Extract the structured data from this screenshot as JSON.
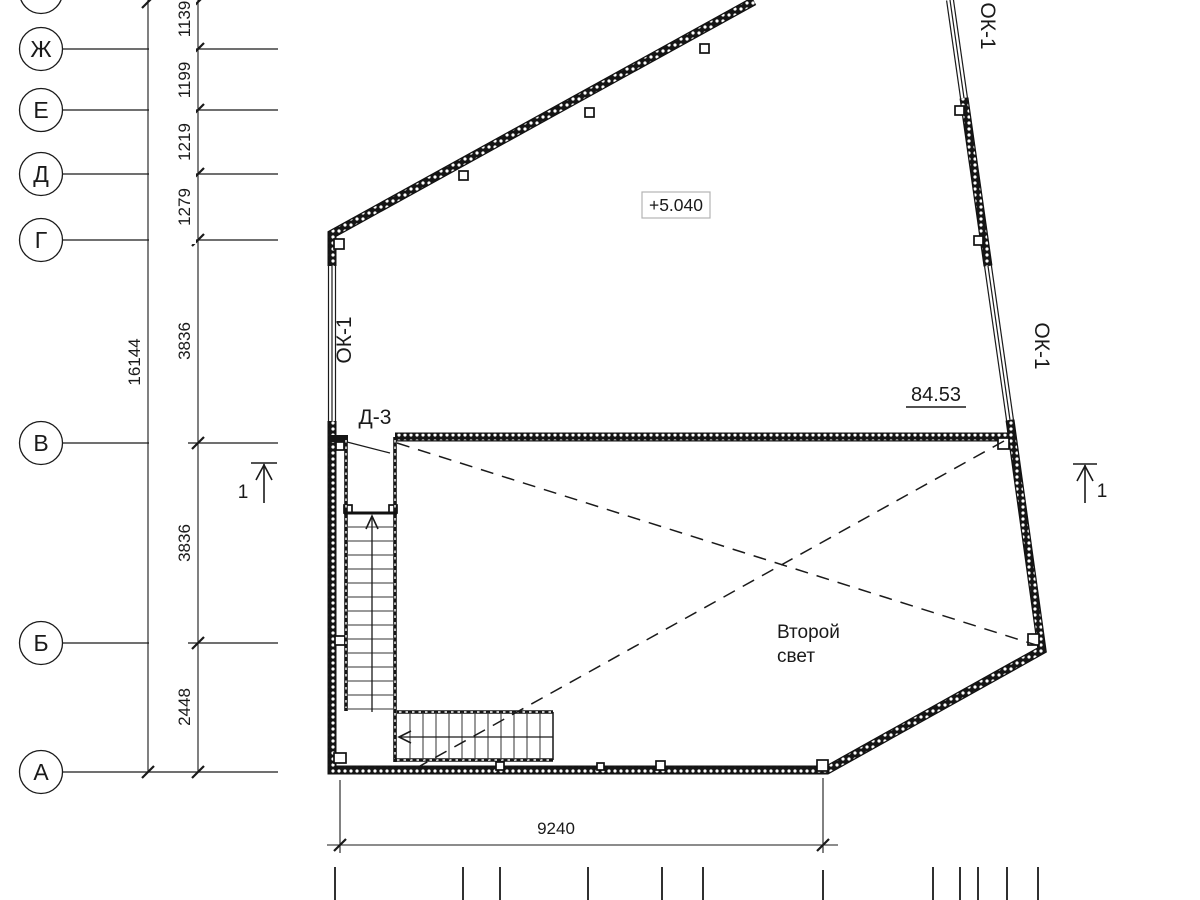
{
  "axes": {
    "labels": [
      "Ж",
      "Е",
      "Д",
      "Г",
      "В",
      "Б",
      "А"
    ]
  },
  "dimensions": {
    "spacings": [
      "1139",
      "1199",
      "1219",
      "1279",
      "3836",
      "3836",
      "2448"
    ],
    "overall": "16144",
    "bottom": "9240"
  },
  "marks": {
    "window_mark": "ОК-1",
    "door_mark": "Д-3",
    "elevation_mark": "+5.040",
    "area_value": "84.53",
    "section_number": "1"
  },
  "room": {
    "void_label_line1": "Второй",
    "void_label_line2": "свет"
  },
  "colors": {
    "line": "#1a1a1a",
    "elevation_box_border": "#b3b3b3",
    "background": "#ffffff"
  }
}
